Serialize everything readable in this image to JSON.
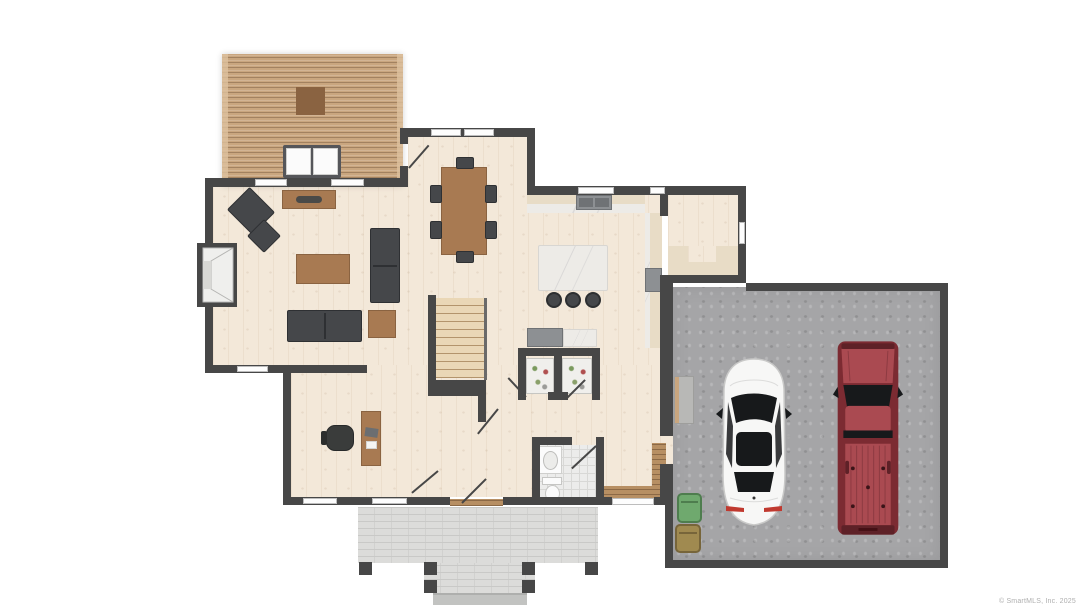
{
  "watermark": {
    "text": "© SmartMLS, Inc. 2025"
  },
  "palette": {
    "wall": "#474747",
    "floor": "#f3e8d9",
    "deck": "#c9a67f",
    "deck_trim": "#ddc19d",
    "wood": "#a87a52",
    "wood_dark": "#8a6341",
    "sofa": "#45474a",
    "seat_line": "#2e3033",
    "marble": "#edebe7",
    "counter": "#e8dcc6",
    "appliance": "#8d9093",
    "tile": "#ececeb",
    "tile_line": "#d8d8d6",
    "garage_floor": "#a5a5a7",
    "porch": "#dcdcda",
    "porch_line": "#c9c9c7",
    "step": "#c2c3c1",
    "window": "#fdfdfd",
    "window_line": "#bdbdbd",
    "fixture": "#fbfbfb",
    "car_white": "#f7f7f6",
    "car_outline": "#c9c9c8",
    "glass": "#17191b",
    "tail_red": "#c0392f",
    "truck_red": "#aa4a51",
    "truck_red_dark": "#7c2b32",
    "truck_red_deep": "#5e2127",
    "bin_green": "#6fa96e",
    "bin_brown": "#a08a50",
    "watermark": "#aeaeae"
  },
  "regions": {
    "list": [
      "deck",
      "living-room",
      "dining-area",
      "kitchen",
      "mudroom",
      "hallway",
      "home-office",
      "half-bathroom",
      "garage",
      "front-porch"
    ]
  },
  "furnishings": {
    "list": [
      "deck-table",
      "outdoor-double-lounger",
      "console-table",
      "armchair",
      "ottoman",
      "coffee-table",
      "sofa",
      "loveseat",
      "side-table",
      "dining-table",
      "dining-chair",
      "kitchen-counter",
      "kitchen-sink",
      "kitchen-island",
      "bar-stool",
      "range-cooktop",
      "refrigerator",
      "side-cabinet",
      "pantry-shelving",
      "staircase",
      "desk",
      "office-chair",
      "vanity-sink",
      "toilet",
      "mudroom-bench",
      "entry-threshold",
      "fireplace",
      "garage-step",
      "trash-bin",
      "porch-post",
      "porch-steps"
    ]
  },
  "vehicles": {
    "list": [
      "white-car",
      "red-pickup-truck"
    ]
  }
}
